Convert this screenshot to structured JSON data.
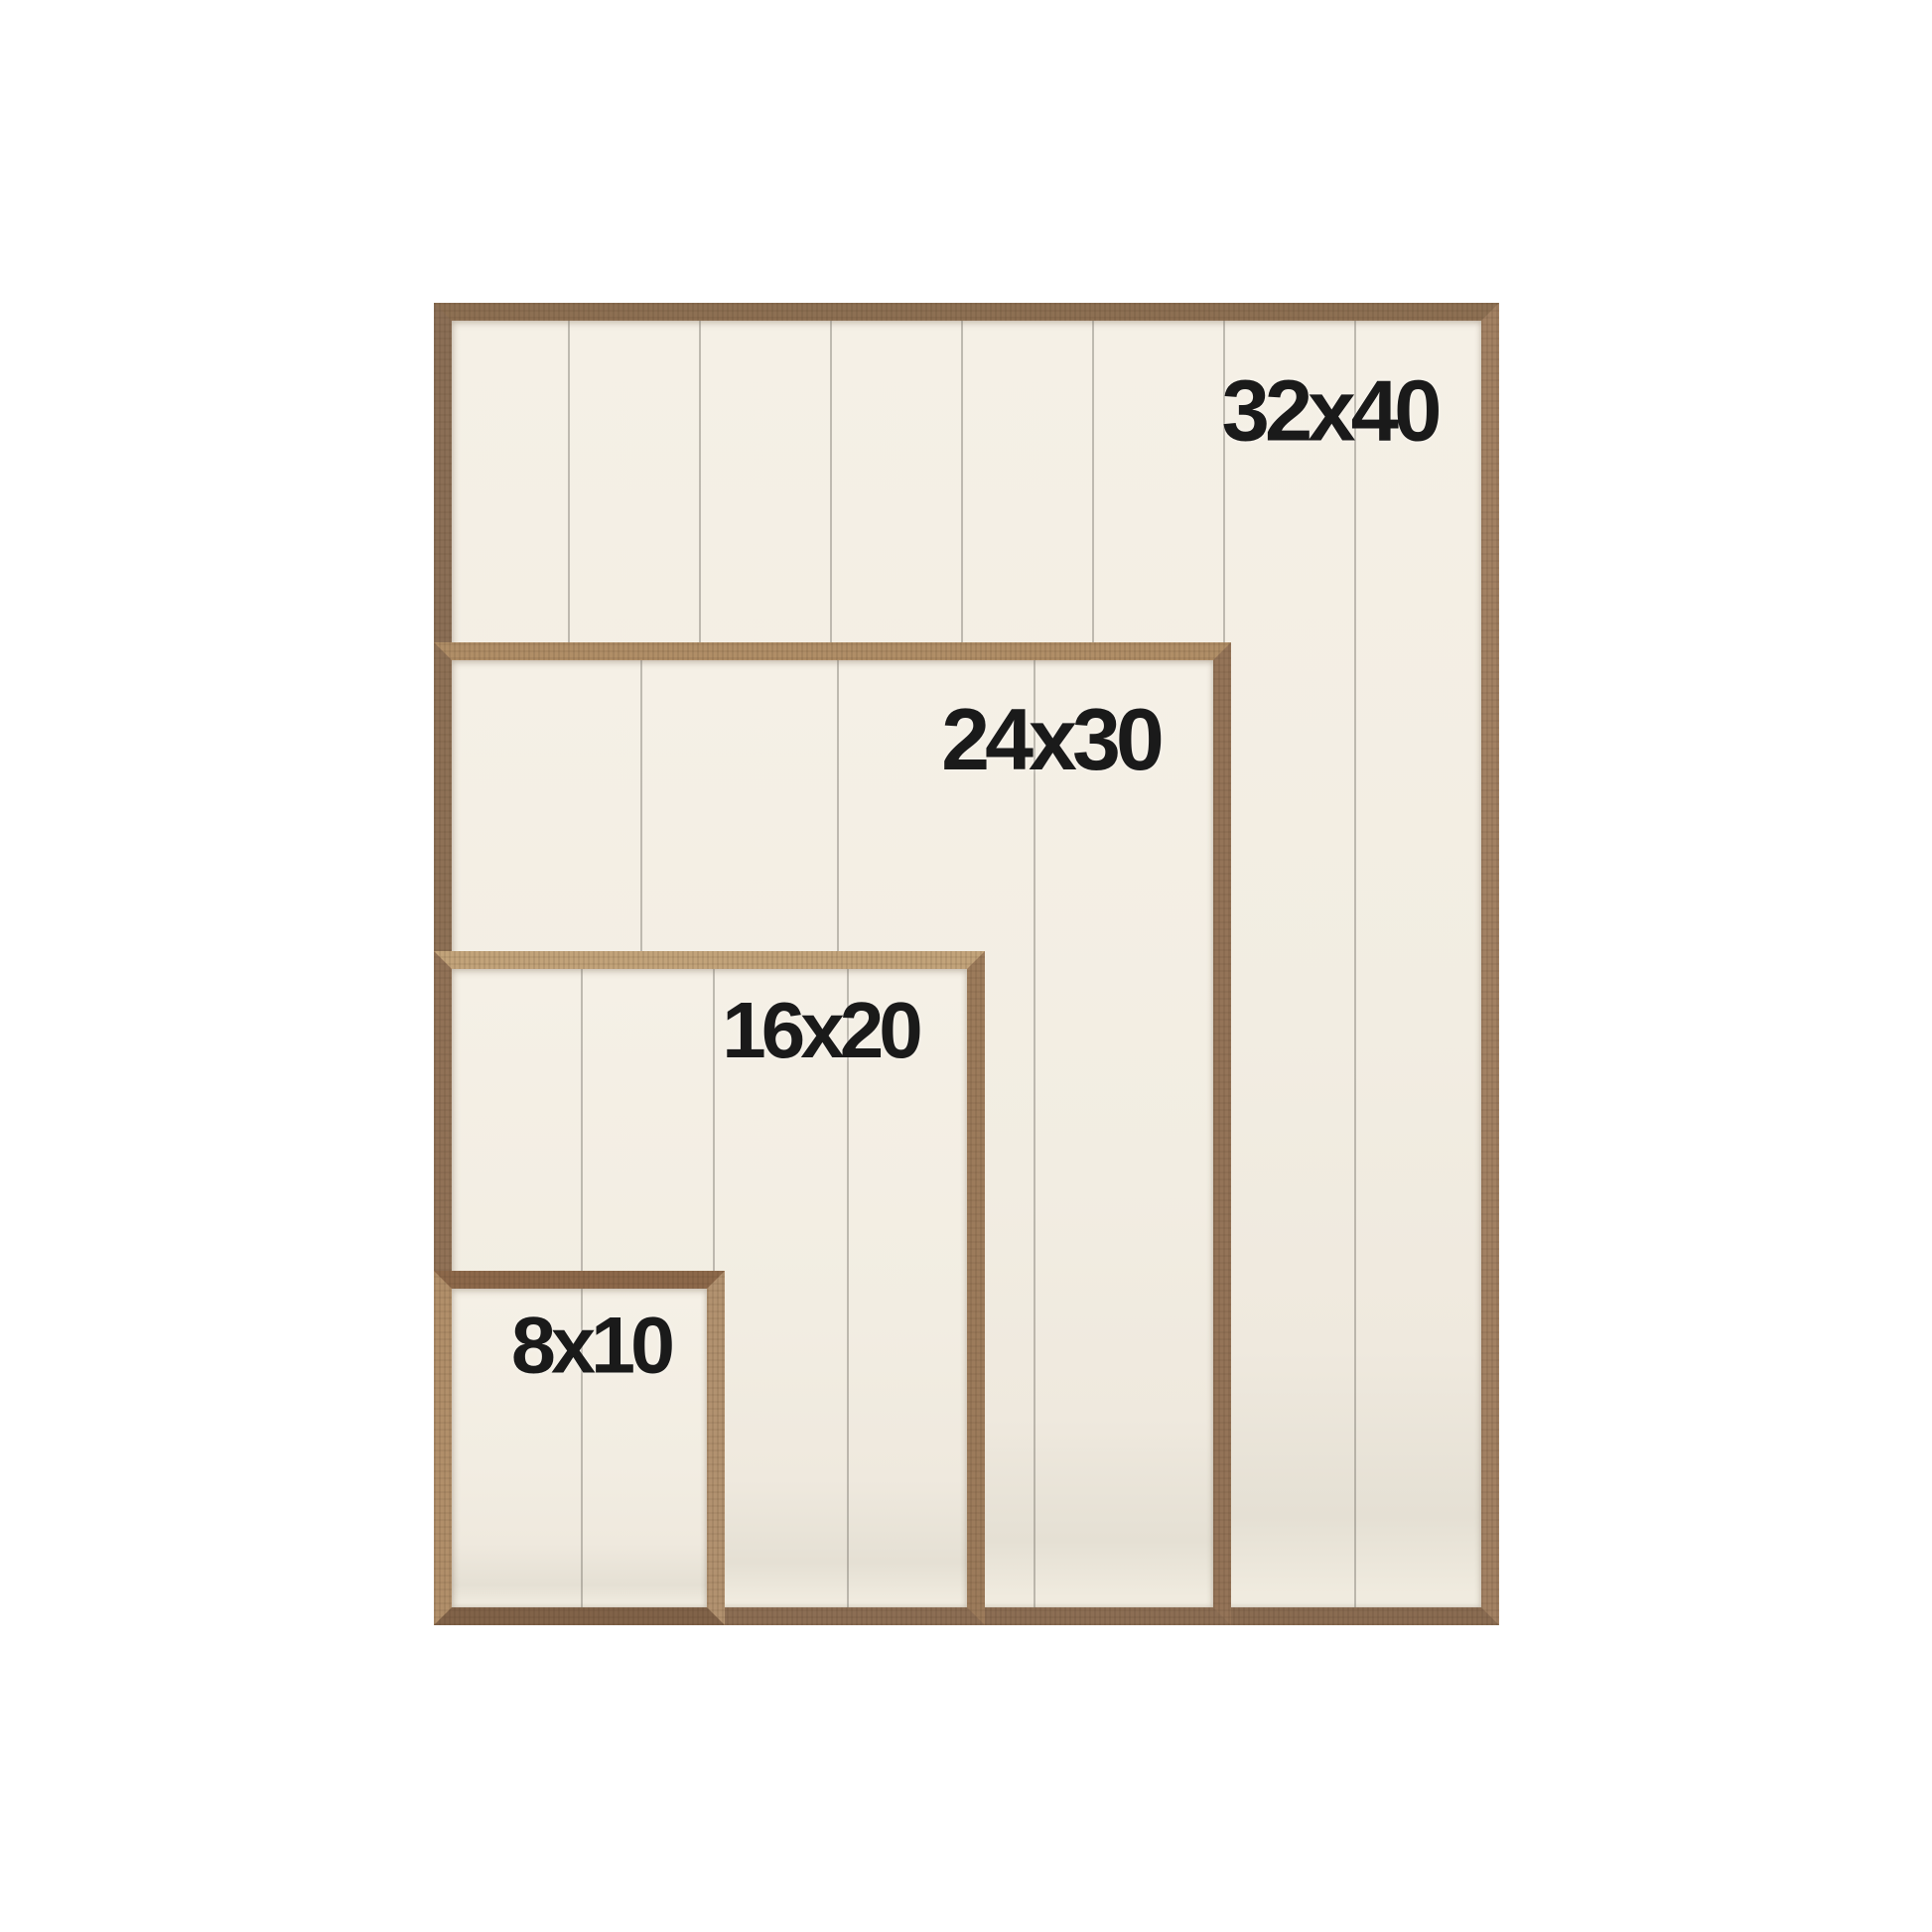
{
  "page": {
    "description_labels_visible": [
      "32x40",
      "24x30",
      "16x20",
      "8x10"
    ],
    "colors": {
      "background": "#ffffff",
      "wood_top_32x40": "#8d7053",
      "wood_top_24x30": "#b08e67",
      "wood_top_16x20": "#c2a37a",
      "wood_top_8x10": "#8c684a",
      "wood_light_edge": "#b29270",
      "panel_cream": "#f2ede2",
      "panel_shadow_band": "#e5e0d4",
      "plank_seam": "#7d786e",
      "label_text": "#1a1a1a"
    }
  },
  "frames": [
    {
      "label": "32x40"
    },
    {
      "label": "24x30"
    },
    {
      "label": "16x20"
    },
    {
      "label": "8x10"
    }
  ]
}
